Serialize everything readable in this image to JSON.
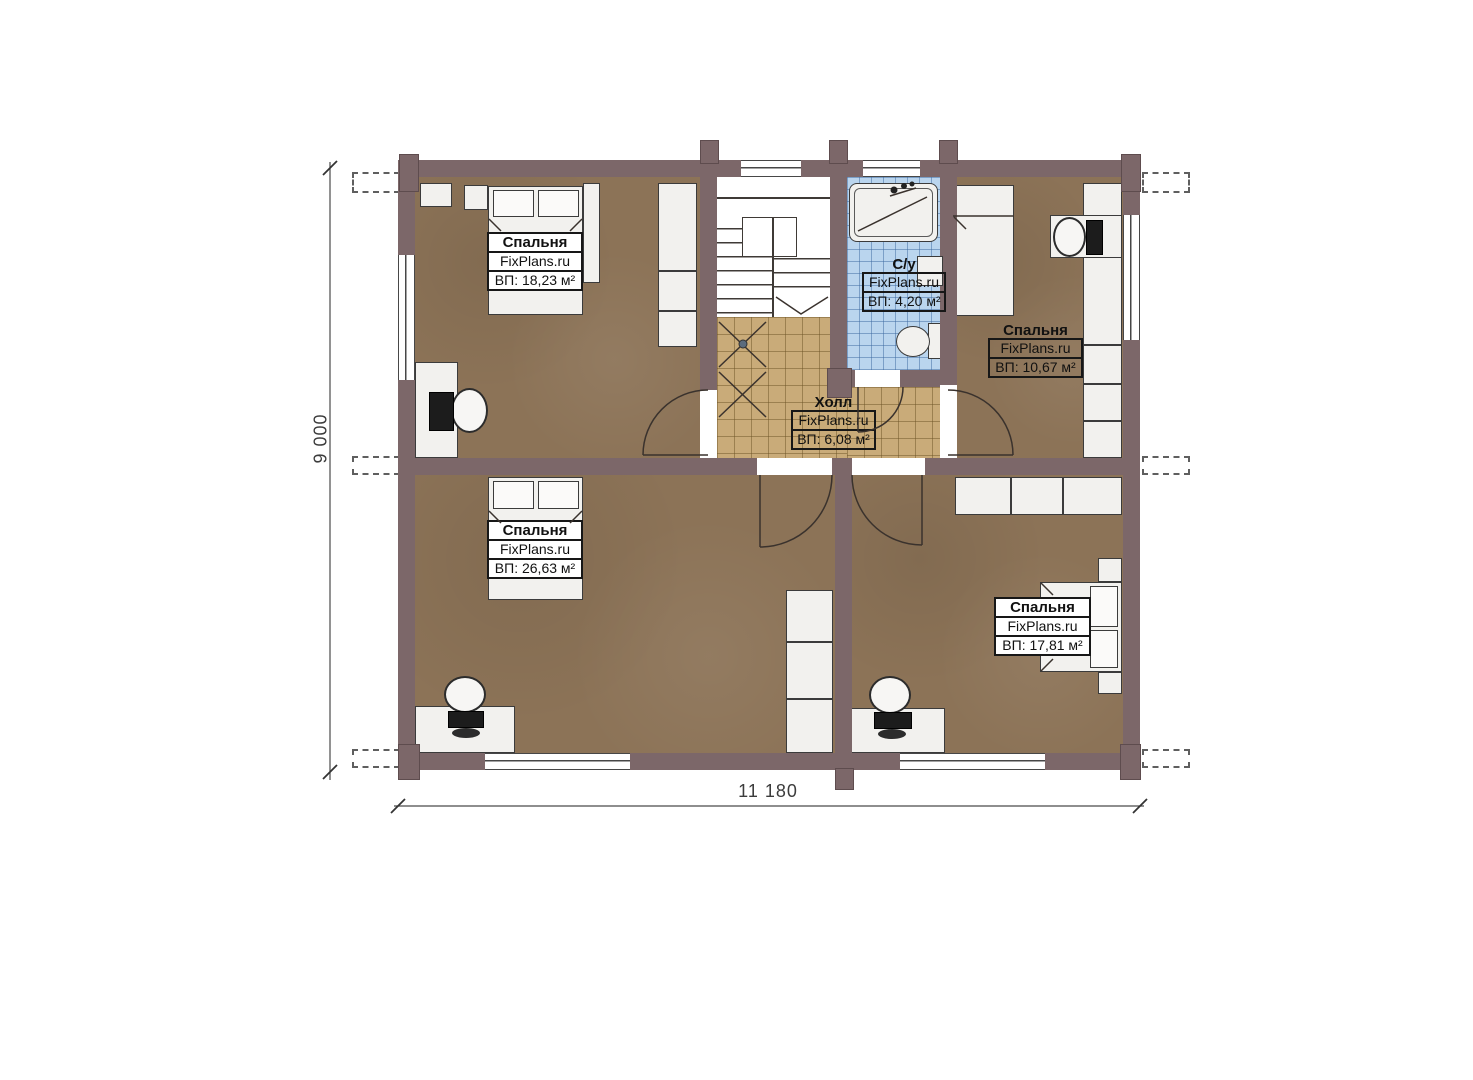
{
  "plan": {
    "brand": "FixPlans.ru",
    "rooms": [
      {
        "id": "bedroom-top-left",
        "name": "Спальня",
        "brand": "FixPlans.ru",
        "area": "ВП: 18,23 м²"
      },
      {
        "id": "bathroom",
        "name": "С/у",
        "brand": "FixPlans.ru",
        "area": "ВП: 4,20 м²"
      },
      {
        "id": "bedroom-top-right",
        "name": "Спальня",
        "brand": "FixPlans.ru",
        "area": "ВП: 10,67 м²"
      },
      {
        "id": "hall",
        "name": "Холл",
        "brand": "FixPlans.ru",
        "area": "ВП: 6,08 м²"
      },
      {
        "id": "bedroom-bottom-left",
        "name": "Спальня",
        "brand": "FixPlans.ru",
        "area": "ВП: 26,63 м²"
      },
      {
        "id": "bedroom-bottom-right",
        "name": "Спальня",
        "brand": "FixPlans.ru",
        "area": "ВП: 17,81 м²"
      }
    ],
    "dimensions": {
      "height": "9 000",
      "width": "11 180"
    },
    "colors": {
      "wall": "#7c6769",
      "bedroom_floor": "#8c7357",
      "hall_floor": "#c9ab79",
      "bath_floor": "#bad5ee",
      "furniture": "#f2f1ee"
    }
  }
}
